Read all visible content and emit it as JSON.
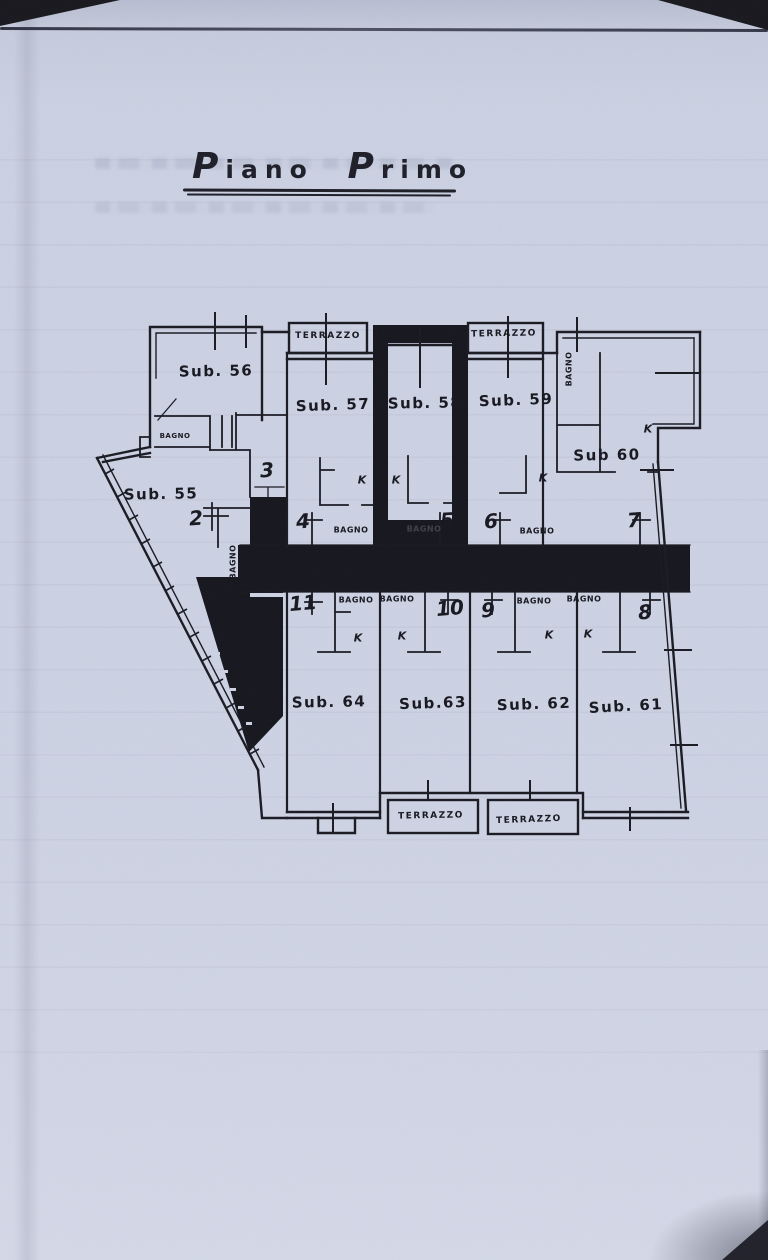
{
  "page": {
    "title_words": [
      "Piano",
      "Primo"
    ]
  },
  "plan": {
    "units": [
      {
        "label": "Sub. 56"
      },
      {
        "label": "Sub. 57"
      },
      {
        "label": "Sub. 58"
      },
      {
        "label": "Sub. 59"
      },
      {
        "label": "Sub 60"
      },
      {
        "label": "Sub. 55"
      },
      {
        "label": "Sub. 64"
      },
      {
        "label": "Sub.63"
      },
      {
        "label": "Sub. 62"
      },
      {
        "label": "Sub. 61"
      }
    ],
    "labels": {
      "bagno": "BAGNO",
      "terrazzo": "TERRAZZO",
      "door_mark": "K"
    },
    "entrances": [
      "2",
      "3",
      "4",
      "5",
      "6",
      "7",
      "8",
      "9",
      "10",
      "11"
    ],
    "colors": {
      "ink": "#17171f",
      "paper": "#ccd2e3"
    }
  }
}
